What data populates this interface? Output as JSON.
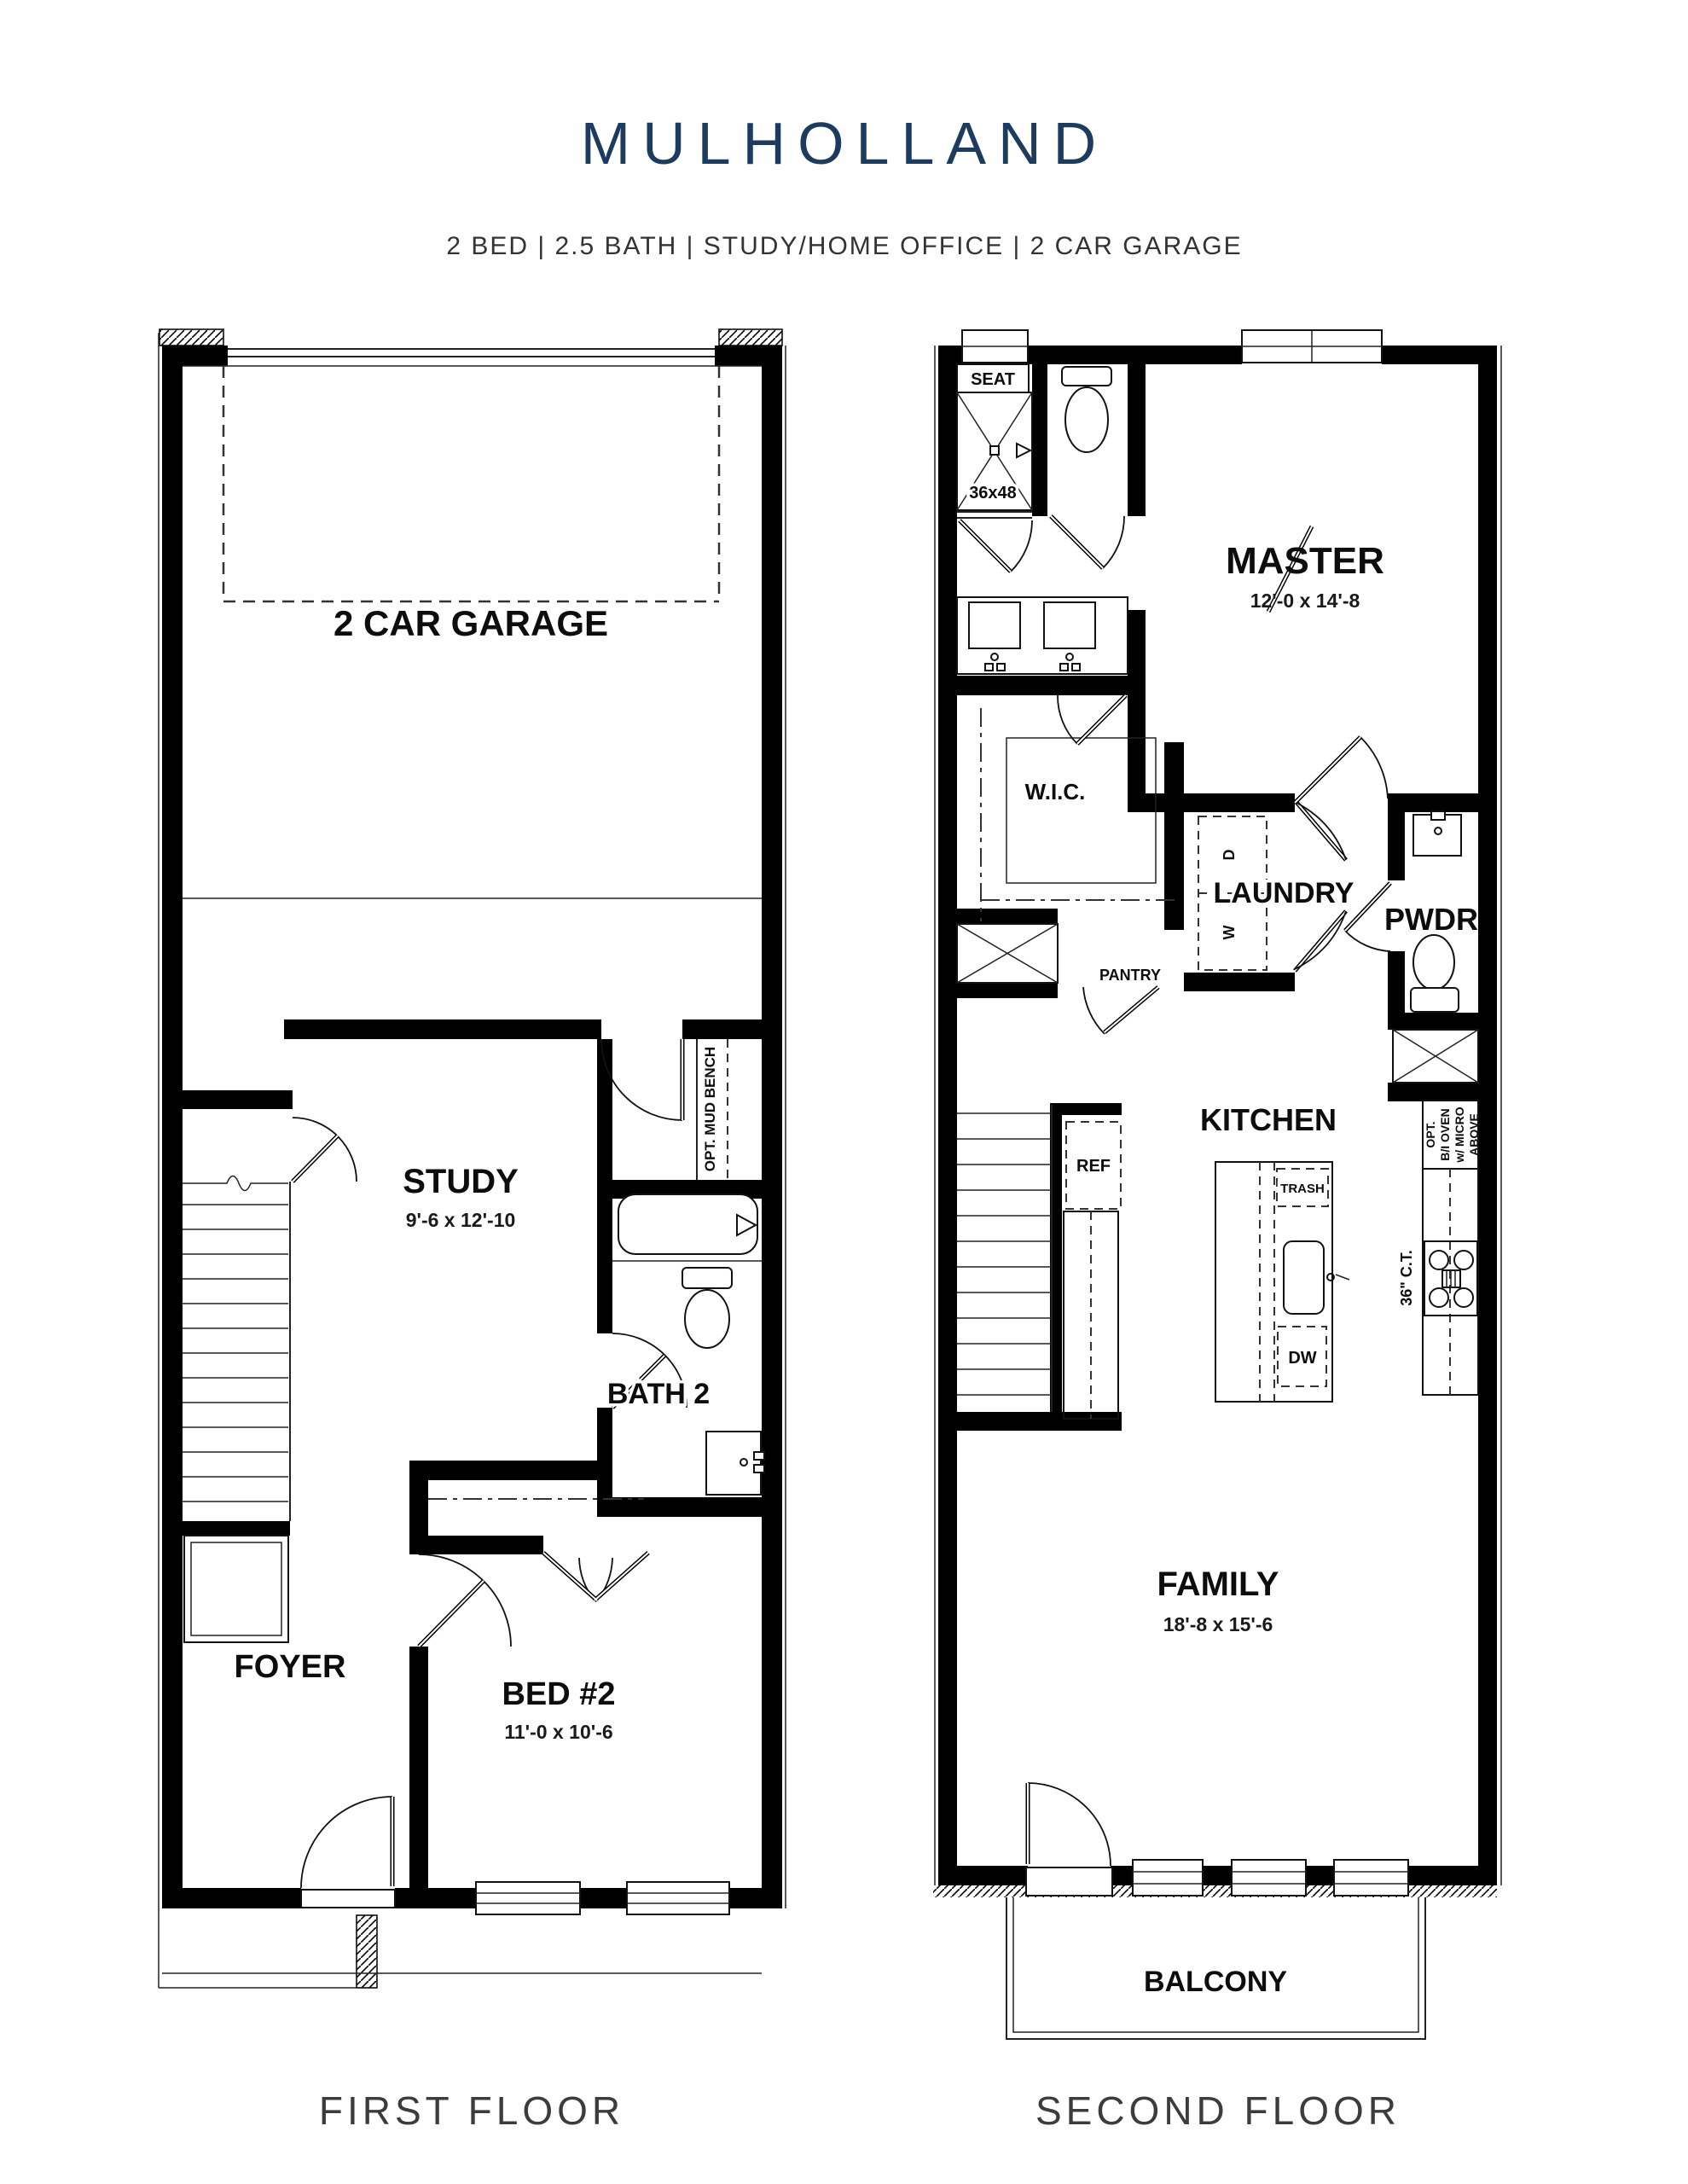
{
  "title": "MULHOLLAND",
  "subtitle": "2 BED | 2.5 BATH | STUDY/HOME OFFICE | 2 CAR GARAGE",
  "colors": {
    "title_navy": "#1d3a5f",
    "ink": "#000000",
    "paper": "#ffffff"
  },
  "first_floor": {
    "caption": "FIRST FLOOR",
    "rooms": {
      "garage": {
        "name": "2 CAR GARAGE"
      },
      "study": {
        "name": "STUDY",
        "dims": "9'-6 x 12'-10"
      },
      "bath2": {
        "name": "BATH 2"
      },
      "foyer": {
        "name": "FOYER"
      },
      "bed2": {
        "name": "BED #2",
        "dims": "11'-0 x 10'-6"
      }
    },
    "annotations": {
      "mud_bench": "OPT. MUD BENCH"
    }
  },
  "second_floor": {
    "caption": "SECOND FLOOR",
    "rooms": {
      "master": {
        "name": "MASTER",
        "dims": "12'-0 x 14'-8"
      },
      "wic": {
        "name": "W.I.C."
      },
      "laundry": {
        "name": "LAUNDRY"
      },
      "pwdr": {
        "name": "PWDR"
      },
      "kitchen": {
        "name": "KITCHEN"
      },
      "pantry": {
        "name": "PANTRY"
      },
      "family": {
        "name": "FAMILY",
        "dims": "18'-8 x 15'-6"
      },
      "balcony": {
        "name": "BALCONY"
      }
    },
    "annotations": {
      "seat": "SEAT",
      "shower_size": "36x48",
      "dryer": "D",
      "washer": "W",
      "ref": "REF",
      "trash": "TRASH",
      "dw": "DW",
      "cooktop": "36\" C.T.",
      "opt_oven_lines": [
        "OPT.",
        "B/I OVEN",
        "w/ MICRO",
        "ABOVE"
      ]
    }
  }
}
